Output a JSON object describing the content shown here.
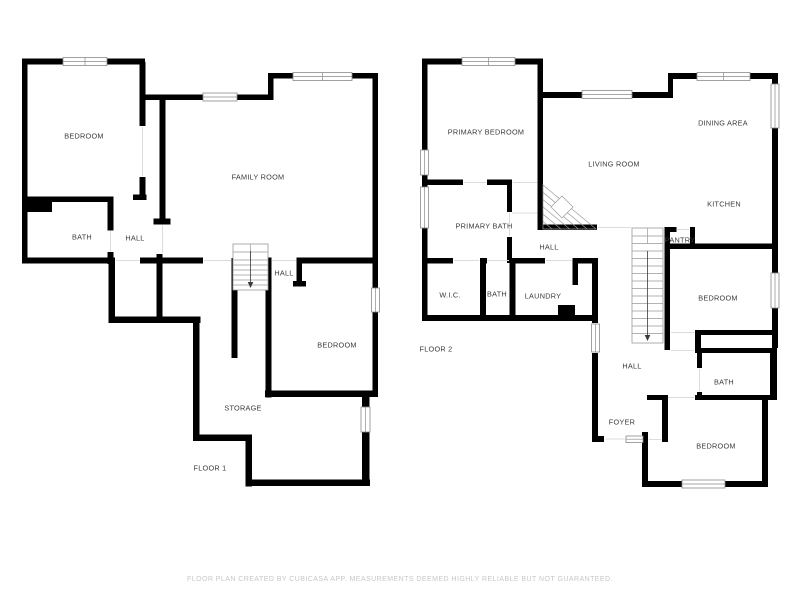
{
  "colors": {
    "background": "#ffffff",
    "wall": "#000000",
    "label": "#3a3a3a",
    "footer": "#c7c7c7",
    "window_border": "#8a8a8a",
    "stair_line": "#9a9a9a",
    "door_line": "#dcdcdc",
    "arrow": "#3a3a3a"
  },
  "footer": {
    "disclaimer": "FLOOR PLAN CREATED BY CUBICASA APP. MEASUREMENTS DEEMED HIGHLY RELIABLE BUT NOT GUARANTEED."
  },
  "floor1": {
    "title": "FLOOR 1",
    "labels": {
      "bedroom_nw": "BEDROOM",
      "family_room": "FAMILY ROOM",
      "bath": "BATH",
      "hall_w": "HALL",
      "hall_c": "HALL",
      "bedroom_se": "BEDROOM",
      "storage": "STORAGE"
    }
  },
  "floor2": {
    "title": "FLOOR 2",
    "labels": {
      "primary_bedroom": "PRIMARY BEDROOM",
      "living_room": "LIVING ROOM",
      "dining_area": "DINING AREA",
      "kitchen": "KITCHEN",
      "primary_bath": "PRIMARY BATH",
      "hall_upper": "HALL",
      "pantry": "PANTRY",
      "wic": "W.I.C.",
      "bath_small": "BATH",
      "laundry": "LAUNDRY",
      "bedroom_mid": "BEDROOM",
      "hall_lower": "HALL",
      "bath_lower": "BATH",
      "foyer": "FOYER",
      "bedroom_se": "BEDROOM"
    }
  }
}
